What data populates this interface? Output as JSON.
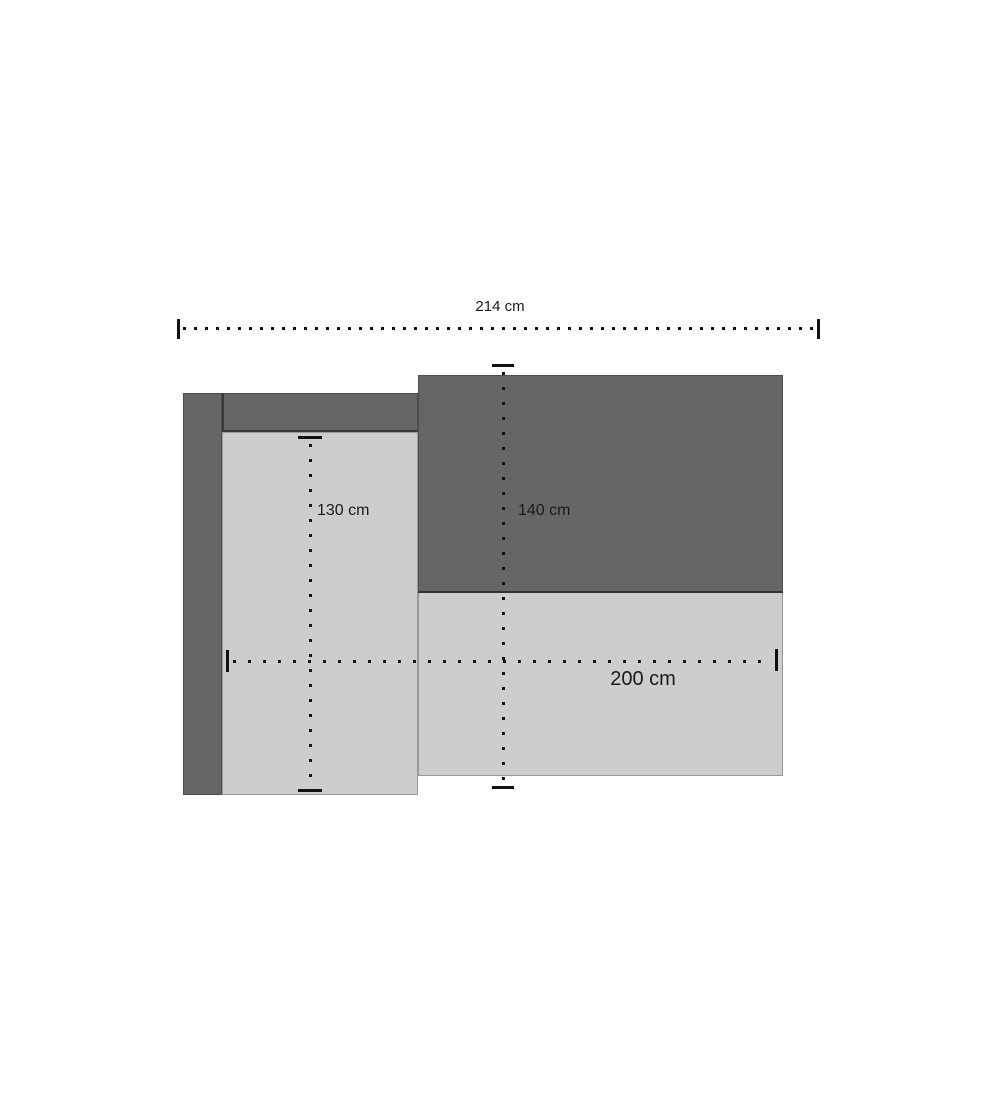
{
  "page": {
    "background": "#ffffff"
  },
  "diagram": {
    "type": "sofa-top-view-dimension-drawing",
    "colors": {
      "dark_upholstery": "#666666",
      "light_upholstery": "#cdcdcd",
      "dimension_line": "#111111",
      "label_text": "#1a1a1a"
    },
    "dimensions": {
      "total_width": "214 cm",
      "chaise_length": "130 cm",
      "total_depth": "140 cm",
      "seat_width": "200 cm"
    }
  }
}
